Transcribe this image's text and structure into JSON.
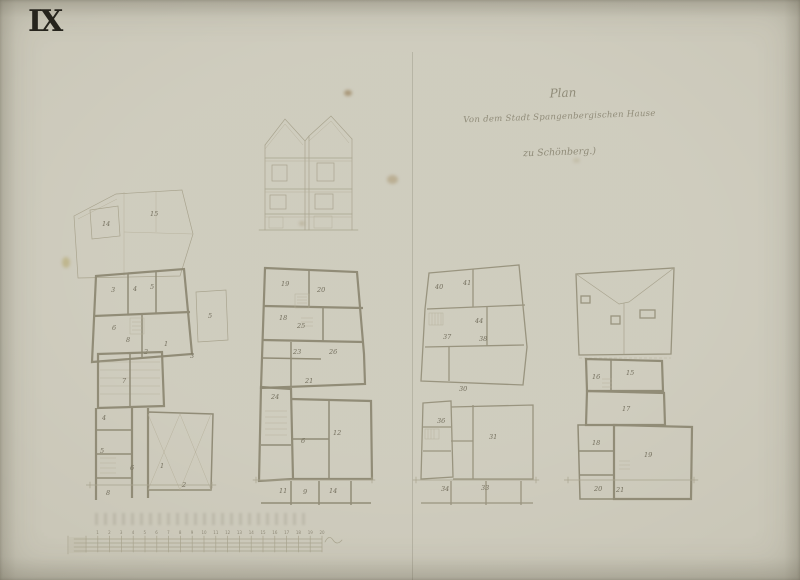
{
  "sheet": {
    "number": "IX"
  },
  "title_block": {
    "line1": "Plan",
    "line2": "Von dem Stadt Spangenbergischen Hause",
    "line3": "zu Schönberg.)"
  },
  "colors": {
    "paper": "#cac7b8",
    "ink": "#26241d",
    "pencil_faint": "#a7a28c",
    "pencil_wall": "#8e8974",
    "script_ink": "#86816d",
    "stain": "#8a6b3f"
  },
  "plans": {
    "sketch": {
      "rooms": [
        "14",
        "15"
      ]
    },
    "ground": {
      "rooms": [
        "3",
        "4",
        "5",
        "6",
        "8",
        "2",
        "1"
      ],
      "annex": "5"
    },
    "ground_south": {
      "rooms": [
        "3",
        "7",
        "4",
        "5",
        "6",
        "1",
        "8",
        "2"
      ]
    },
    "first": {
      "rooms": [
        "19",
        "20",
        "18",
        "25",
        "23",
        "26",
        "21"
      ]
    },
    "first_south": {
      "rooms": [
        "24",
        "6",
        "12",
        "11",
        "9",
        "14"
      ]
    },
    "second": {
      "rooms": [
        "40",
        "41",
        "44",
        "37",
        "38"
      ]
    },
    "second_south": {
      "rooms": [
        "30",
        "36",
        "31",
        "34",
        "33"
      ]
    },
    "attic": {
      "rooms": [
        "16",
        "15",
        "17",
        "18",
        "19",
        "20",
        "21"
      ]
    }
  },
  "scale_bar": {
    "ticks": [
      "1",
      "2",
      "3",
      "4",
      "5",
      "6",
      "7",
      "8",
      "9",
      "10",
      "11",
      "12",
      "13",
      "14",
      "15",
      "16",
      "17",
      "18",
      "19",
      "20"
    ]
  }
}
